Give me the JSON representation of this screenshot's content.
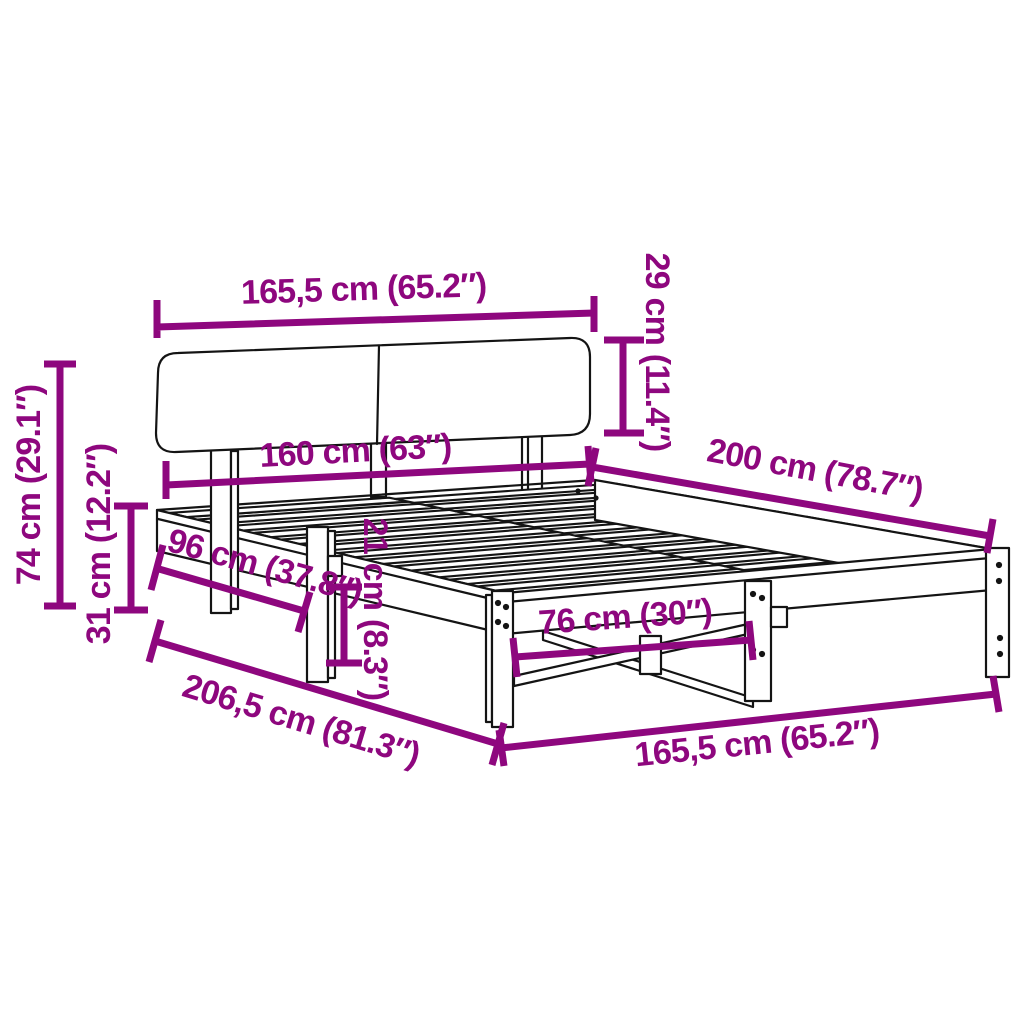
{
  "diagram": {
    "type": "product-dimension-diagram",
    "subject": "bed-frame-with-headboard-and-slats",
    "background_color": "#FFFFFF",
    "line_color": "#141414",
    "accent_color": "#8E077E"
  },
  "dimensions": {
    "headboard_width_top": "165,5 cm (65.2″)",
    "headboard_height": "29 cm (11.4″)",
    "mattress_width": "160 cm (63″)",
    "frame_length": "200 cm (78.7″)",
    "total_height": "74 cm (29.1″)",
    "under_frame_height": "31 cm (12.2″)",
    "side_leg_spacing": "96 cm (37.8″)",
    "frame_edge_height": "21 cm (8.3″)",
    "foot_leg_spacing": "76 cm (30″)",
    "overall_length": "206,5 cm (81.3″)",
    "frame_width_foot": "165,5 cm (65.2″)"
  }
}
